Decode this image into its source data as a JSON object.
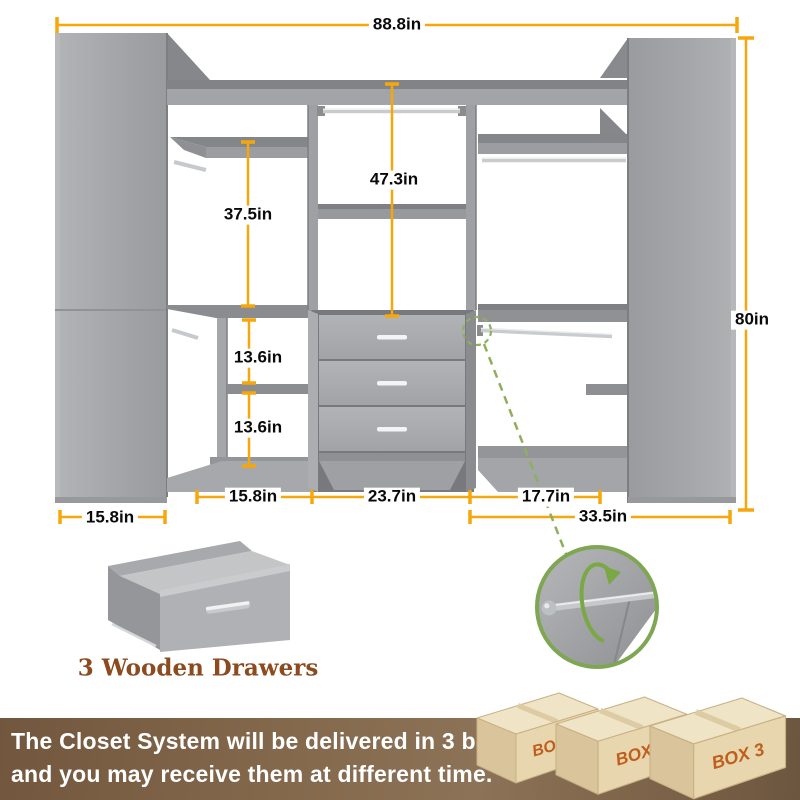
{
  "colors": {
    "dimension_accent": "#F6A70B",
    "detail_green": "#7FA653",
    "closet_grey": "#A2A4A7",
    "caption_brown": "#8C4A1F",
    "banner_brown": "#7A6147",
    "box_label_orange": "#C05E1D"
  },
  "diagram": {
    "dim_total_width": "88.8in",
    "dim_total_height": "80in",
    "dim_center_height": "47.3in",
    "dim_left_height": "37.5in",
    "dim_cubby_top": "13.6in",
    "dim_cubby_bottom": "13.6in",
    "dim_left_col_width": "15.8in",
    "dim_center_col_width": "23.7in",
    "dim_right_col_width": "17.7in",
    "dim_tower_depth": "15.8in",
    "dim_right_total": "33.5in",
    "drawer_caption": "3 Wooden Drawers"
  },
  "banner": {
    "line1": "The Closet System will be delivered in 3 boxes",
    "line2": "and you may receive them at different time.",
    "boxes": [
      {
        "label": "BOX 1"
      },
      {
        "label": "BOX 2"
      },
      {
        "label": "BOX 3"
      }
    ]
  }
}
